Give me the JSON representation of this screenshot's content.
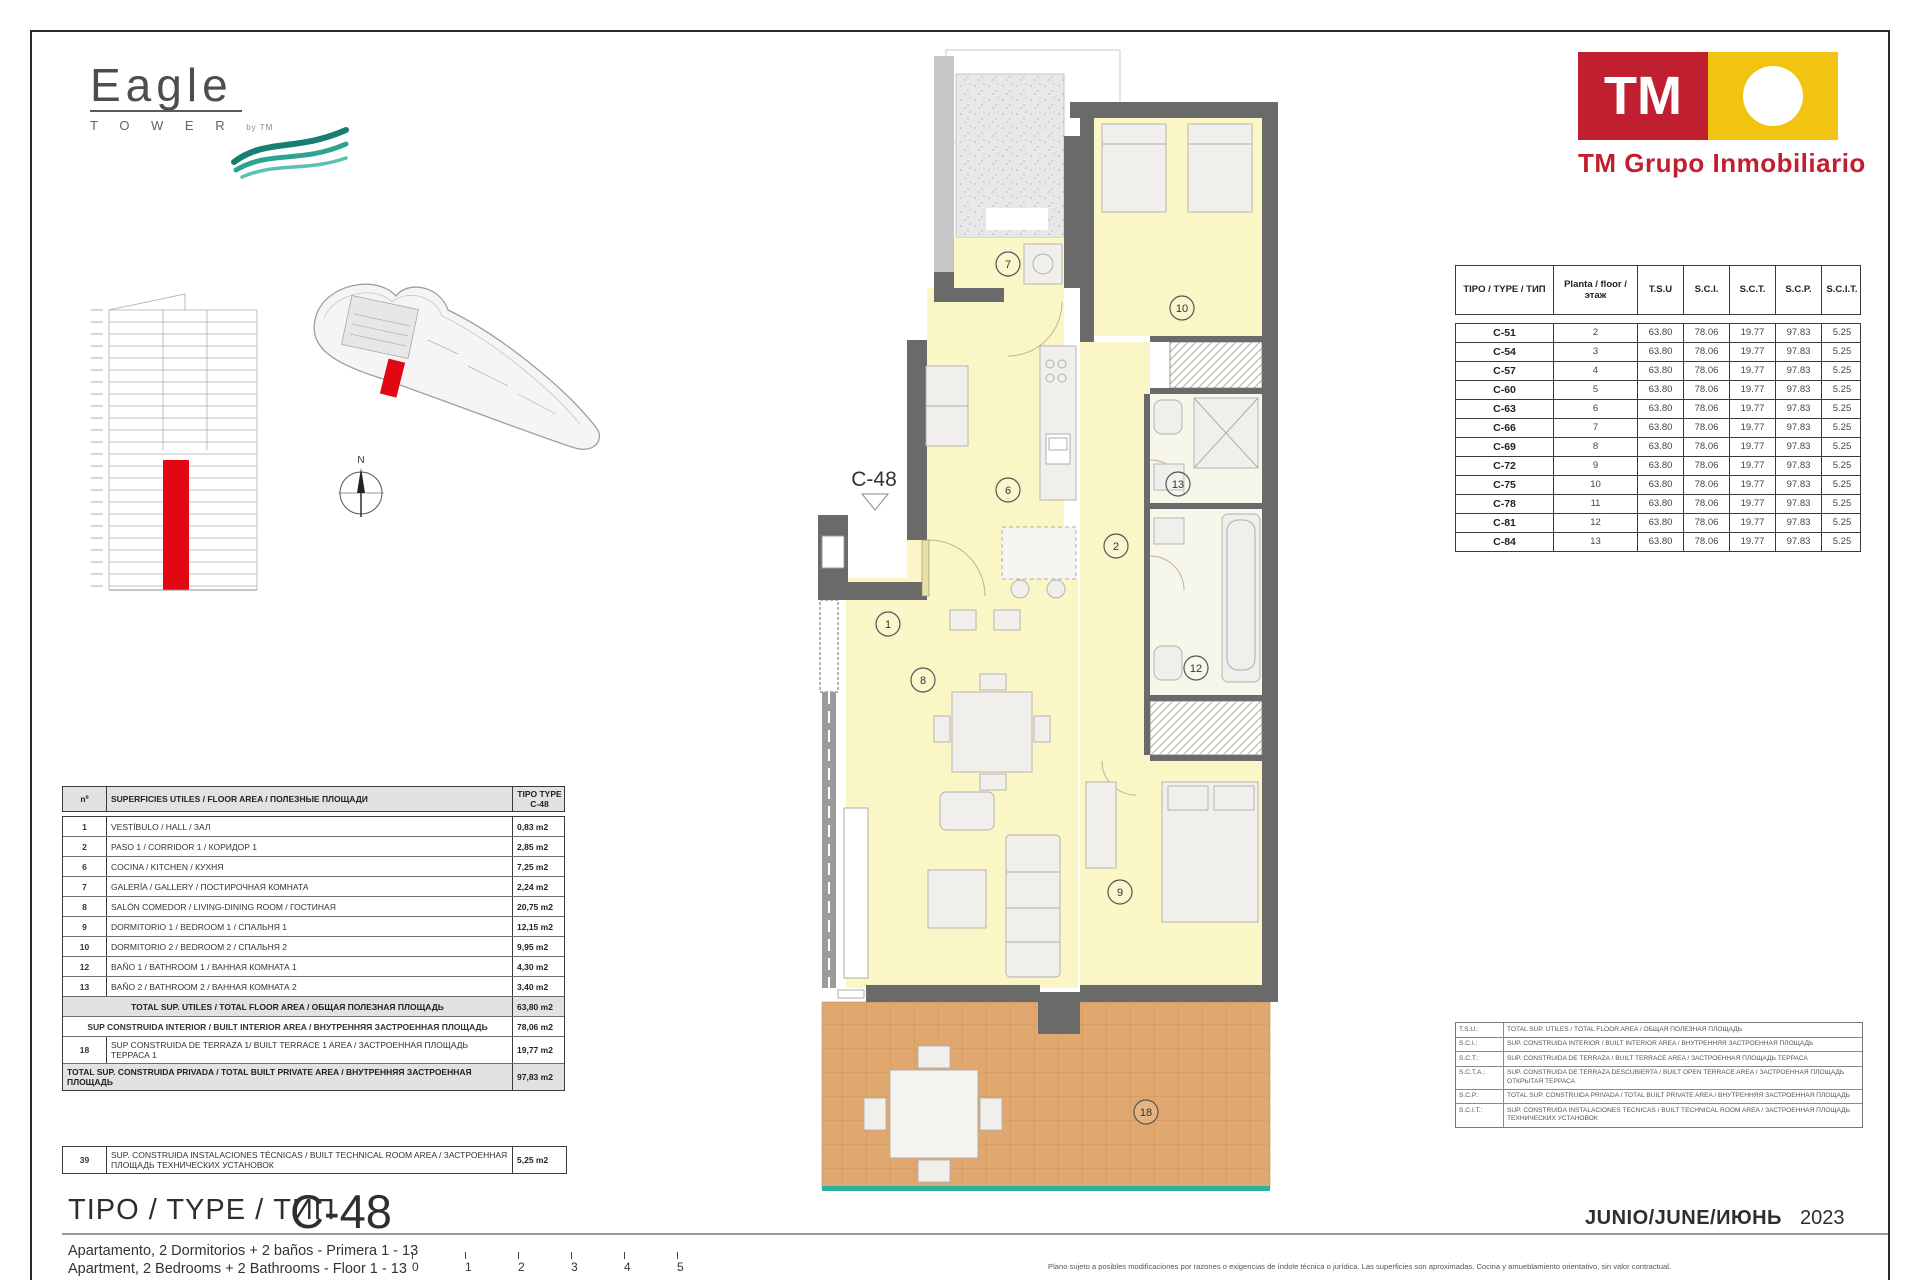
{
  "branding": {
    "eagle": {
      "name": "Eagle",
      "sub": "T O W E R",
      "by": "by TM"
    },
    "tm": {
      "initials": "TM",
      "caption": "TM Grupo Inmobiliario",
      "red": "#c01f2f",
      "yellow": "#f2c412"
    }
  },
  "type_table": {
    "headers": [
      "TIPO / TYPE / ТИП",
      "Planta / floor / этаж",
      "T.S.U",
      "S.C.I.",
      "S.C.T.",
      "S.C.P.",
      "S.C.I.T."
    ],
    "rows": [
      [
        "C-51",
        "2",
        "63.80",
        "78.06",
        "19.77",
        "97.83",
        "5.25"
      ],
      [
        "C-54",
        "3",
        "63.80",
        "78.06",
        "19.77",
        "97.83",
        "5.25"
      ],
      [
        "C-57",
        "4",
        "63.80",
        "78.06",
        "19.77",
        "97.83",
        "5.25"
      ],
      [
        "C-60",
        "5",
        "63.80",
        "78.06",
        "19.77",
        "97.83",
        "5.25"
      ],
      [
        "C-63",
        "6",
        "63.80",
        "78.06",
        "19.77",
        "97.83",
        "5.25"
      ],
      [
        "C-66",
        "7",
        "63.80",
        "78.06",
        "19.77",
        "97.83",
        "5.25"
      ],
      [
        "C-69",
        "8",
        "63.80",
        "78.06",
        "19.77",
        "97.83",
        "5.25"
      ],
      [
        "C-72",
        "9",
        "63.80",
        "78.06",
        "19.77",
        "97.83",
        "5.25"
      ],
      [
        "C-75",
        "10",
        "63.80",
        "78.06",
        "19.77",
        "97.83",
        "5.25"
      ],
      [
        "C-78",
        "11",
        "63.80",
        "78.06",
        "19.77",
        "97.83",
        "5.25"
      ],
      [
        "C-81",
        "12",
        "63.80",
        "78.06",
        "19.77",
        "97.83",
        "5.25"
      ],
      [
        "C-84",
        "13",
        "63.80",
        "78.06",
        "19.77",
        "97.83",
        "5.25"
      ]
    ]
  },
  "area_table": {
    "col_num": "nº",
    "col_title": "SUPERFICIES UTILES / FLOOR AREA / ПОЛЕЗНЫЕ ПЛОЩАДИ",
    "col_type": "TIPO TYPE",
    "col_type2": "C-48",
    "rows": [
      {
        "n": "1",
        "label": "VESTÍBULO / HALL / ЗАЛ",
        "value": "0,83 m2"
      },
      {
        "n": "2",
        "label": "PASO 1 /  CORRIDOR 1 / КОРИДОР 1",
        "value": "2,85 m2"
      },
      {
        "n": "6",
        "label": "COCINA / KITCHEN / КУХНЯ",
        "value": "7,25 m2"
      },
      {
        "n": "7",
        "label": "GALERÍA / GALLERY / ПОСТИРОЧНАЯ КОМНАТА",
        "value": "2,24 m2"
      },
      {
        "n": "8",
        "label": "SALÓN COMEDOR  / LIVING-DINING ROOM / ГОСТИНАЯ",
        "value": "20,75 m2"
      },
      {
        "n": "9",
        "label": "DORMITORIO 1 / BEDROOM 1 / СПАЛЬНЯ 1",
        "value": "12,15 m2"
      },
      {
        "n": "10",
        "label": "DORMITORIO 2 / BEDROOM 2 / СПАЛЬНЯ 2",
        "value": "9,95 m2"
      },
      {
        "n": "12",
        "label": "BAÑO 1 / BATHROOM 1 / ВАННАЯ КОМНАТА 1",
        "value": "4,30 m2"
      },
      {
        "n": "13",
        "label": "BAÑO 2 / BATHROOM 2 / ВАННАЯ КОМНАТА 2",
        "value": "3,40 m2"
      }
    ],
    "summary": [
      {
        "n": "",
        "label": "TOTAL  SUP. UTILES / TOTAL FLOOR AREA / ОБЩАЯ ПОЛЕЗНАЯ ПЛОЩАДЬ",
        "value": "63,80 m2",
        "shaded": true
      },
      {
        "n": "",
        "label": "SUP CONSTRUIDA INTERIOR / BUILT INTERIOR AREA / ВНУТРЕННЯЯ ЗАСТРОЕННАЯ ПЛОЩАДЬ",
        "value": "78,06 m2",
        "shaded": false
      },
      {
        "n": "18",
        "label": "SUP CONSTRUIDA DE TERRAZA 1/ BUILT TERRACE 1 AREA / ЗАСТРОЕННАЯ ПЛОЩАДЬ ТЕРРАСА 1",
        "value": "19,77 m2",
        "shaded": false
      },
      {
        "n": "",
        "label": "TOTAL SUP. CONSTRUIDA PRIVADA / TOTAL  BUILT PRIVATE AREA / ВНУТРЕННЯЯ ЗАСТРОЕННАЯ ПЛОЩАДЬ",
        "value": "97,83 m2",
        "shaded": true
      }
    ],
    "tech": {
      "n": "39",
      "label": "SUP. CONSTRUIDA INSTALACIONES TÉCNICAS / BUILT TECHNICAL ROOM AREA / ЗАСТРОЕННАЯ ПЛОЩАДЬ ТЕХНИЧЕСКИХ УСТАНОВОК",
      "value": "5,25 m2"
    }
  },
  "plan": {
    "unit": "C-48",
    "compass": "N",
    "markers": [
      {
        "n": "7",
        "x": 358,
        "y": 224
      },
      {
        "n": "10",
        "x": 532,
        "y": 268
      },
      {
        "n": "6",
        "x": 358,
        "y": 450
      },
      {
        "n": "13",
        "x": 528,
        "y": 444
      },
      {
        "n": "2",
        "x": 466,
        "y": 506
      },
      {
        "n": "1",
        "x": 238,
        "y": 584
      },
      {
        "n": "8",
        "x": 273,
        "y": 640
      },
      {
        "n": "12",
        "x": 546,
        "y": 628
      },
      {
        "n": "9",
        "x": 470,
        "y": 852
      },
      {
        "n": "18",
        "x": 496,
        "y": 1072
      }
    ]
  },
  "legend": {
    "rows": [
      {
        "abbr": "T.S.U.:",
        "text": "TOTAL SUP. UTILES / TOTAL FLOOR AREA / ОБЩАЯ ПОЛЕЗНАЯ ПЛОЩАДЬ"
      },
      {
        "abbr": "S.C.I.:",
        "text": "SUP. CONSTRUIDA INTERIOR / BUILT INTERIOR AREA / ВНУТРЕННЯЯ ЗАСТРОЕННАЯ ПЛОЩАДЬ"
      },
      {
        "abbr": "S.C.T.:",
        "text": "SUP. CONSTRUIDA DE TERRAZA / BUILT TERRACE AREA / ЗАСТРОЕННАЯ ПЛОЩАДЬ ТЕРРАСА"
      },
      {
        "abbr": "S.C.T.A.:",
        "text": "SUP. CONSTRUIDA DE TERRAZA DESCUBIERTA / BUILT OPEN TERRACE AREA / ЗАСТРОЕННАЯ ПЛОЩАДЬ ОТКРЫТАЯ ТЕРРАСА"
      },
      {
        "abbr": "S.C.P.:",
        "text": "TOTAL SUP. CONSTRUIDA PRIVADA / TOTAL BUILT PRIVATE AREA / ВНУТРЕННЯЯ ЗАСТРОЕННАЯ ПЛОЩАДЬ"
      },
      {
        "abbr": "S.C.I.T.:",
        "text": "SUP. CONSTRUIDA INSTALACIONES TECNICAS / BUILT TECHNICAL ROOM AREA / ЗАСТРОЕННАЯ ПЛОЩАДЬ ТЕХНИЧЕСКИХ УСТАНОВОК"
      }
    ]
  },
  "footer": {
    "type_label": "TIPO / TYPE / ТИП",
    "type_code": "C-48",
    "desc_es": "Apartamento, 2 Dormitorios + 2 baños - Primera 1 - 13",
    "desc_en": "Apartment, 2 Bedrooms + 2 Bathrooms - Floor 1 - 13",
    "scale": [
      "0",
      "1",
      "2",
      "3",
      "4",
      "5"
    ],
    "date": "JUNIO/JUNE/ИЮНЬ",
    "year": "2023",
    "disclaimer": "Plano sujeto a posibles modificaciones por razones o exigencias de índole técnica o jurídica. Las superficies son aproximadas. Cocina y amueblamiento orientativo, sin valor contractual."
  }
}
